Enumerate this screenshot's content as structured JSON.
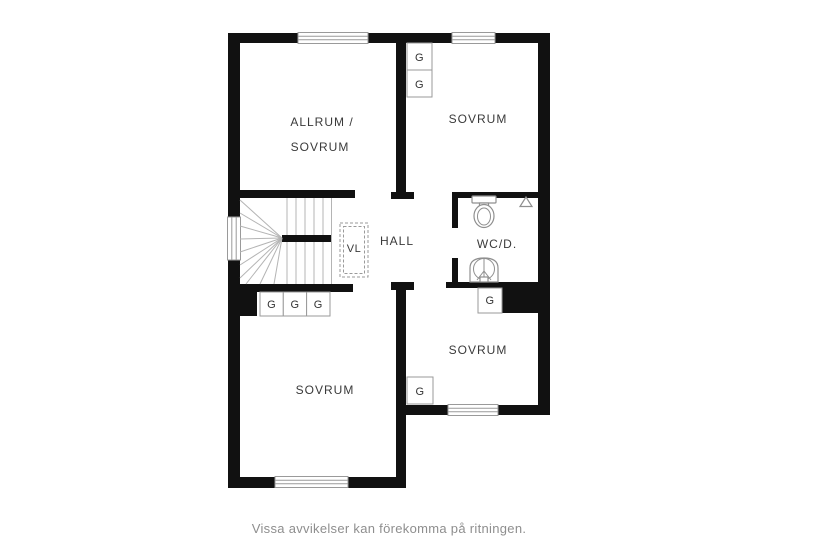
{
  "plan": {
    "labels": {
      "room_allrum_line1": "ALLRUM /",
      "room_allrum_line2": "SOVRUM",
      "room_sovrum_ne": "SOVRUM",
      "room_sovrum_sw": "SOVRUM",
      "room_sovrum_se": "SOVRUM",
      "hall": "HALL",
      "wc": "WC/D.",
      "vl": "VL"
    },
    "closets": [
      {
        "id": "closet-ne-top",
        "label": "G"
      },
      {
        "id": "closet-ne-bottom",
        "label": "G"
      },
      {
        "id": "closet-sw-1",
        "label": "G"
      },
      {
        "id": "closet-sw-2",
        "label": "G"
      },
      {
        "id": "closet-sw-3",
        "label": "G"
      },
      {
        "id": "closet-wc",
        "label": "G"
      },
      {
        "id": "closet-se",
        "label": "G"
      }
    ]
  },
  "caption": "Vissa avvikelser kan förekomma på ritningen.",
  "colors": {
    "wall": "#111111",
    "fixture": "#8f8f8f",
    "stair": "#b4b4b4",
    "closet-border": "#9a9a9a",
    "label": "#3a3a3a",
    "caption": "#8e8e8e",
    "bg": "#ffffff"
  }
}
